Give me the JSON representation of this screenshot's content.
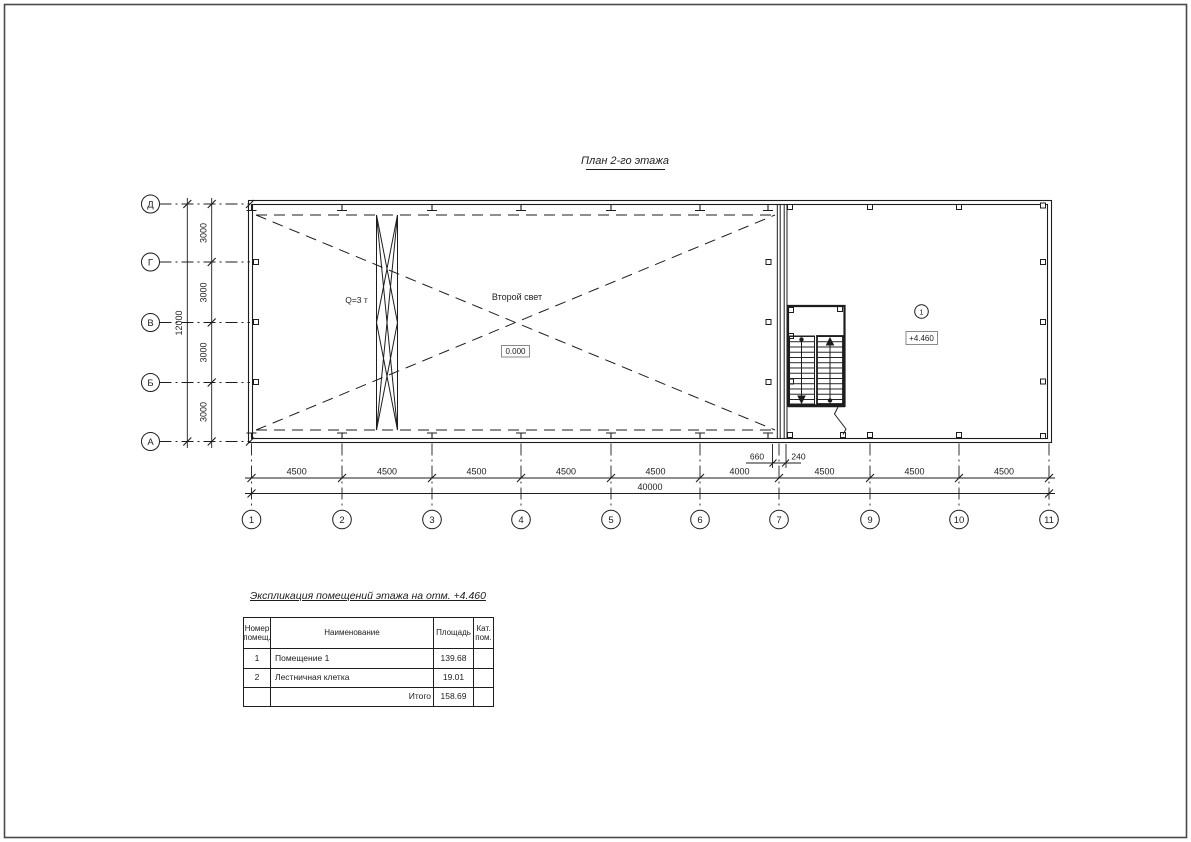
{
  "drawing": {
    "title": "План 2-го этажа",
    "annotations": {
      "crane": "Q=3 т",
      "second_light": "Второй свет",
      "level_zero": "0.000",
      "level_second": "+4.460",
      "room_marker": "1"
    },
    "axes": {
      "rows": [
        "Д",
        "Г",
        "В",
        "Б",
        "А"
      ],
      "row_dims": [
        "3000",
        "3000",
        "3000",
        "3000"
      ],
      "row_total": "12000",
      "cols": [
        "1",
        "2",
        "3",
        "4",
        "5",
        "6",
        "7",
        "9",
        "10",
        "11"
      ],
      "col_dims": [
        "4500",
        "4500",
        "4500",
        "4500",
        "4500",
        "4000",
        "4500",
        "4500",
        "4500"
      ],
      "col_total": "40000",
      "stair_dims": [
        "660",
        "240"
      ]
    }
  },
  "table": {
    "title": "Экспликация помещений этажа на отм. +4.460",
    "headers": {
      "num": [
        "Номер",
        "помещ."
      ],
      "name": "Наименование",
      "area": "Площадь",
      "cat": [
        "Кат.",
        "пом."
      ]
    },
    "rows": [
      {
        "num": "1",
        "name": "Помещение 1",
        "area": "139.68",
        "cat": ""
      },
      {
        "num": "2",
        "name": "Лестничная клетка",
        "area": "19.01",
        "cat": ""
      }
    ],
    "total_label": "Итого",
    "total_area": "158.69",
    "total_cat": ""
  },
  "colors": {
    "ink": "#1d1d1d",
    "box_stroke": "#8a8a8a"
  }
}
